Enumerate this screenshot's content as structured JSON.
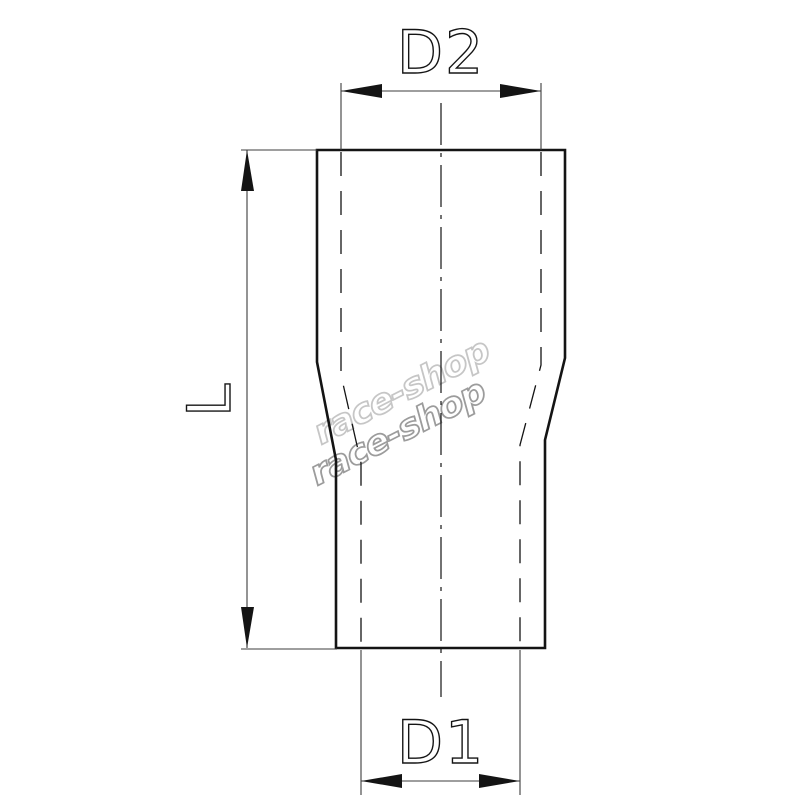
{
  "drawing": {
    "title": "reducer-hose-coupler-dimension-drawing",
    "labels": {
      "top_diameter": "D2",
      "bottom_diameter": "D1",
      "length": "L"
    },
    "watermark": {
      "line1": "race-shop",
      "line2": "race-shop"
    },
    "colors": {
      "background": "#ffffff",
      "line": "#141414",
      "dimension": "#3d3d3d",
      "watermark_light": "#c6c6c6",
      "watermark_dark": "#9c9c9c"
    }
  }
}
